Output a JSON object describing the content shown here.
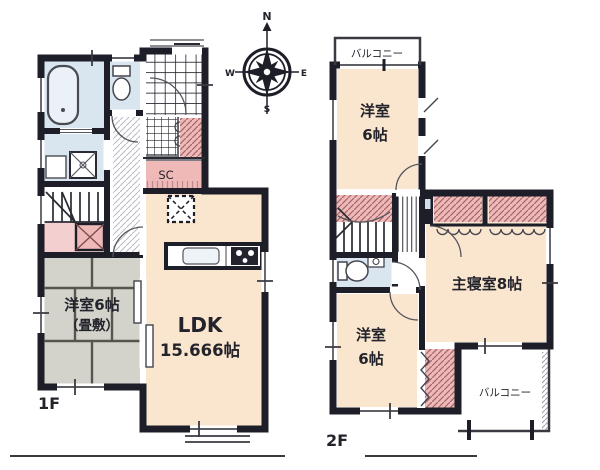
{
  "floor1": {
    "label": "1F",
    "ldk": {
      "line1": "LDK",
      "line2": "15.666帖"
    },
    "tatami_room": {
      "line1": "洋室6帖",
      "line2": "（畳敷）"
    },
    "shoe_closet_label": "SC"
  },
  "floor2": {
    "label": "2F",
    "room_north": {
      "line1": "洋室",
      "line2": "6帖"
    },
    "master_bedroom_label": "主寝室8帖",
    "room_south": {
      "line1": "洋室",
      "line2": "6帖"
    },
    "balcony_north_label": "バルコニー",
    "balcony_south_label": "バルコニー"
  },
  "compass": {
    "north": "N",
    "south": "S",
    "east": "E",
    "west": "W"
  },
  "colors": {
    "wall": "#1e1e28",
    "room_cream": "#fae6cf",
    "tatami_gray": "#d3d3cb",
    "water_blue": "#d9e6f0",
    "closet_pink": "#efb9b8",
    "stair_pink": "#f3cfcf"
  }
}
